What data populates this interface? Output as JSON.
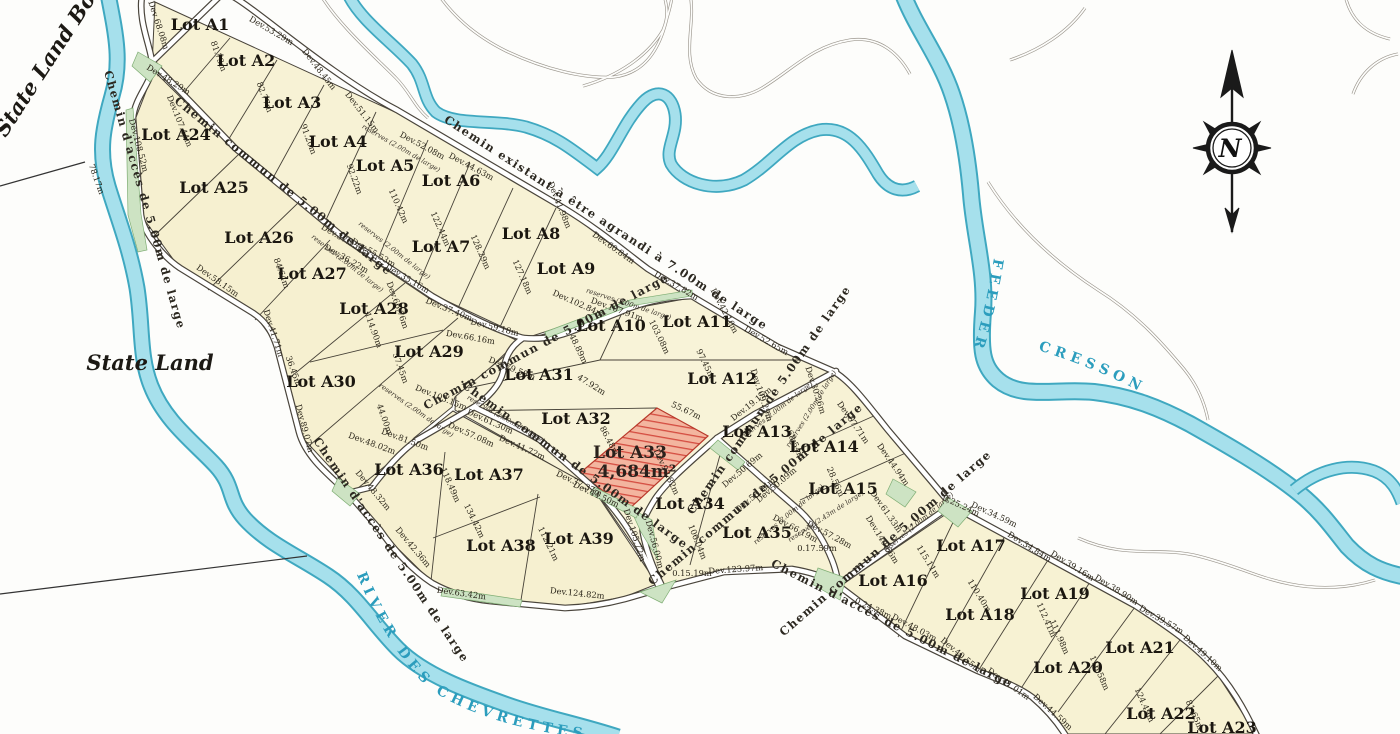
{
  "labels": {
    "state_land": "State Land",
    "state_land_boundary": "State Land Bou",
    "river_left": "RIVER DES CHEVRETTES",
    "feeder": "FEEDER",
    "cresson": "CRESSON",
    "compass_n": "N"
  },
  "highlight": {
    "lot": "Lot A33",
    "area": "4,684m²"
  },
  "colors": {
    "parcel_fill": "#f7f2d5",
    "water_fill": "#a6e0ec",
    "water_edge": "#3fa8c0",
    "highlight_red": "#d84b3c",
    "reserve_green": "#cde3c3",
    "river_text": "#2b9dbd"
  },
  "lots": [
    {
      "id": "A1",
      "label": "Lot A1",
      "x": 200,
      "y": 30
    },
    {
      "id": "A2",
      "label": "Lot A2",
      "x": 246,
      "y": 66
    },
    {
      "id": "A3",
      "label": "Lot A3",
      "x": 292,
      "y": 108
    },
    {
      "id": "A4",
      "label": "Lot A4",
      "x": 338,
      "y": 147
    },
    {
      "id": "A5",
      "label": "Lot A5",
      "x": 385,
      "y": 171
    },
    {
      "id": "A6",
      "label": "Lot A6",
      "x": 451,
      "y": 186
    },
    {
      "id": "A7",
      "label": "Lot A7",
      "x": 441,
      "y": 252
    },
    {
      "id": "A8",
      "label": "Lot A8",
      "x": 531,
      "y": 239
    },
    {
      "id": "A9",
      "label": "Lot A9",
      "x": 566,
      "y": 274
    },
    {
      "id": "A10",
      "label": "Lot A10",
      "x": 611,
      "y": 331
    },
    {
      "id": "A11",
      "label": "Lot A11",
      "x": 697,
      "y": 327
    },
    {
      "id": "A12",
      "label": "Lot A12",
      "x": 722,
      "y": 384
    },
    {
      "id": "A13",
      "label": "Lot A13",
      "x": 757,
      "y": 437
    },
    {
      "id": "A14",
      "label": "Lot A14",
      "x": 824,
      "y": 452
    },
    {
      "id": "A15",
      "label": "Lot A15",
      "x": 843,
      "y": 494
    },
    {
      "id": "A16",
      "label": "Lot A16",
      "x": 893,
      "y": 586
    },
    {
      "id": "A17",
      "label": "Lot A17",
      "x": 971,
      "y": 551
    },
    {
      "id": "A18",
      "label": "Lot A18",
      "x": 980,
      "y": 620
    },
    {
      "id": "A19",
      "label": "Lot A19",
      "x": 1055,
      "y": 599
    },
    {
      "id": "A20",
      "label": "Lot A20",
      "x": 1068,
      "y": 673
    },
    {
      "id": "A21",
      "label": "Lot A21",
      "x": 1140,
      "y": 653
    },
    {
      "id": "A22",
      "label": "Lot A22",
      "x": 1161,
      "y": 719
    },
    {
      "id": "A23",
      "label": "Lot A23",
      "x": 1222,
      "y": 733
    },
    {
      "id": "A24",
      "label": "Lot A24",
      "x": 176,
      "y": 140
    },
    {
      "id": "A25",
      "label": "Lot A25",
      "x": 214,
      "y": 193
    },
    {
      "id": "A26",
      "label": "Lot A26",
      "x": 259,
      "y": 243
    },
    {
      "id": "A27",
      "label": "Lot A27",
      "x": 312,
      "y": 279
    },
    {
      "id": "A28",
      "label": "Lot A28",
      "x": 374,
      "y": 314
    },
    {
      "id": "A29",
      "label": "Lot A29",
      "x": 429,
      "y": 357
    },
    {
      "id": "A30",
      "label": "Lot A30",
      "x": 321,
      "y": 387
    },
    {
      "id": "A31",
      "label": "Lot A31",
      "x": 539,
      "y": 380
    },
    {
      "id": "A32",
      "label": "Lot A32",
      "x": 576,
      "y": 424
    },
    {
      "id": "A34",
      "label": "Lot A34",
      "x": 690,
      "y": 509
    },
    {
      "id": "A35",
      "label": "Lot A35",
      "x": 757,
      "y": 538
    },
    {
      "id": "A36",
      "label": "Lot A36",
      "x": 409,
      "y": 475
    },
    {
      "id": "A37",
      "label": "Lot A37",
      "x": 489,
      "y": 480
    },
    {
      "id": "A38",
      "label": "Lot A38",
      "x": 501,
      "y": 551
    },
    {
      "id": "A39",
      "label": "Lot A39",
      "x": 579,
      "y": 544
    }
  ],
  "road_labels": [
    {
      "t": "Chemin existant à être agrandi à 7.00m de large",
      "x": 604,
      "y": 226,
      "r": 33
    },
    {
      "t": "Chemin d'accès de 5.00m de large",
      "x": 141,
      "y": 201,
      "r": 74
    },
    {
      "t": "Chemin d'accès de 5.00m de large",
      "x": 388,
      "y": 552,
      "r": 56
    },
    {
      "t": "Chemin d'accès de 5.00m de large",
      "x": 890,
      "y": 627,
      "r": 27
    },
    {
      "t": "Chemin commun de 5.00m de large",
      "x": 281,
      "y": 189,
      "r": 39
    },
    {
      "t": "Chemin commun de 5.00m de large",
      "x": 548,
      "y": 345,
      "r": -28
    },
    {
      "t": "Chemin commun de 5.00m de large",
      "x": 573,
      "y": 468,
      "r": 36
    },
    {
      "t": "Chemin commun de 5.00m de large",
      "x": 772,
      "y": 402,
      "r": -55
    },
    {
      "t": "Chemin commun de 5.00m de large",
      "x": 888,
      "y": 546,
      "r": -41
    },
    {
      "t": "Chemin commun de 5.00m de large",
      "x": 758,
      "y": 497,
      "r": -40
    }
  ],
  "dimensions": [
    {
      "t": "Dev 68.08m",
      "x": 156,
      "y": 26,
      "r": 72
    },
    {
      "t": "Dev.53.29m",
      "x": 270,
      "y": 33,
      "r": 30
    },
    {
      "t": "Dev.48.45m",
      "x": 317,
      "y": 71,
      "r": 52
    },
    {
      "t": "Dev.51.15m",
      "x": 360,
      "y": 114,
      "r": 52
    },
    {
      "t": "81.73m",
      "x": 216,
      "y": 57,
      "r": 70
    },
    {
      "t": "82.77m",
      "x": 262,
      "y": 98,
      "r": 70
    },
    {
      "t": "91.20m",
      "x": 306,
      "y": 140,
      "r": 70
    },
    {
      "t": "92.22m",
      "x": 352,
      "y": 180,
      "r": 70
    },
    {
      "t": "Dev.48.29m",
      "x": 167,
      "y": 82,
      "r": 32
    },
    {
      "t": "Dev.107.44m",
      "x": 177,
      "y": 122,
      "r": 68
    },
    {
      "t": "Dev.108.52m",
      "x": 136,
      "y": 146,
      "r": 75
    },
    {
      "t": "78.17m",
      "x": 94,
      "y": 180,
      "r": 70
    },
    {
      "t": "Dev.52.08m",
      "x": 421,
      "y": 148,
      "r": 28
    },
    {
      "t": "Dev.44.63m",
      "x": 470,
      "y": 169,
      "r": 28
    },
    {
      "t": "110.42m",
      "x": 396,
      "y": 207,
      "r": 66
    },
    {
      "t": "122.44m",
      "x": 438,
      "y": 230,
      "r": 66
    },
    {
      "t": "128.29m",
      "x": 478,
      "y": 253,
      "r": 66
    },
    {
      "t": "127.18m",
      "x": 520,
      "y": 278,
      "r": 66
    },
    {
      "t": "Dev.41.98m",
      "x": 557,
      "y": 206,
      "r": 68
    },
    {
      "t": "Dev.60.84m",
      "x": 612,
      "y": 250,
      "r": 35
    },
    {
      "t": "Dev.102.84m",
      "x": 577,
      "y": 306,
      "r": 24
    },
    {
      "t": "Dev.107.91m",
      "x": 616,
      "y": 312,
      "r": 20
    },
    {
      "t": "Dev.37.82m",
      "x": 675,
      "y": 288,
      "r": 30
    },
    {
      "t": "Dev.42.10m",
      "x": 722,
      "y": 312,
      "r": 62
    },
    {
      "t": "Dev.52.65m",
      "x": 765,
      "y": 343,
      "r": 30
    },
    {
      "t": "103.08m",
      "x": 657,
      "y": 338,
      "r": 64
    },
    {
      "t": "97.45m",
      "x": 703,
      "y": 365,
      "r": 64
    },
    {
      "t": "48.89m",
      "x": 576,
      "y": 350,
      "r": 64
    },
    {
      "t": "47.92m",
      "x": 590,
      "y": 387,
      "r": 32
    },
    {
      "t": "55.67m",
      "x": 685,
      "y": 413,
      "r": 25
    },
    {
      "t": "86.48m",
      "x": 607,
      "y": 442,
      "r": 62
    },
    {
      "t": "Dev.79.58m",
      "x": 511,
      "y": 371,
      "r": 22
    },
    {
      "t": "Dev.61.30m",
      "x": 489,
      "y": 424,
      "r": 24
    },
    {
      "t": "Dev.57.08m",
      "x": 470,
      "y": 437,
      "r": 24
    },
    {
      "t": "Dev.41.72m",
      "x": 521,
      "y": 450,
      "r": 24
    },
    {
      "t": "Dev.37.37m",
      "x": 578,
      "y": 486,
      "r": 25
    },
    {
      "t": "Dev.44.50m",
      "x": 595,
      "y": 497,
      "r": 25
    },
    {
      "t": "118.49m",
      "x": 448,
      "y": 486,
      "r": 66
    },
    {
      "t": "134.42m",
      "x": 472,
      "y": 522,
      "r": 64
    },
    {
      "t": "112.21m",
      "x": 546,
      "y": 545,
      "r": 64
    },
    {
      "t": "Dev.48.32m",
      "x": 371,
      "y": 492,
      "r": 50
    },
    {
      "t": "Dev.42.36m",
      "x": 411,
      "y": 549,
      "r": 50
    },
    {
      "t": "Dev.63.42m",
      "x": 461,
      "y": 596,
      "r": 8
    },
    {
      "t": "Dev.124.82m",
      "x": 577,
      "y": 596,
      "r": 6
    },
    {
      "t": "44.00m",
      "x": 382,
      "y": 420,
      "r": 70
    },
    {
      "t": "Dev.48.02m",
      "x": 371,
      "y": 446,
      "r": 20
    },
    {
      "t": "Dev.81.50m",
      "x": 404,
      "y": 442,
      "r": 20
    },
    {
      "t": "Dev.103.15m",
      "x": 440,
      "y": 400,
      "r": 22
    },
    {
      "t": "114.90m",
      "x": 371,
      "y": 331,
      "r": 70
    },
    {
      "t": "57.45m",
      "x": 398,
      "y": 369,
      "r": 70
    },
    {
      "t": "36.45m",
      "x": 291,
      "y": 372,
      "r": 70
    },
    {
      "t": "Dev.58.15m",
      "x": 216,
      "y": 283,
      "r": 35
    },
    {
      "t": "Dev.41.71m",
      "x": 271,
      "y": 334,
      "r": 72
    },
    {
      "t": "Dev.89.07m",
      "x": 302,
      "y": 429,
      "r": 75
    },
    {
      "t": "84.64m",
      "x": 279,
      "y": 274,
      "r": 70
    },
    {
      "t": "Dev.55.53m",
      "x": 372,
      "y": 255,
      "r": 30
    },
    {
      "t": "Dev.35.16m",
      "x": 406,
      "y": 281,
      "r": 30
    },
    {
      "t": "Dev.66.76m",
      "x": 395,
      "y": 306,
      "r": 70
    },
    {
      "t": "Dev.37.40m",
      "x": 448,
      "y": 312,
      "r": 22
    },
    {
      "t": "Dev.59.18m",
      "x": 494,
      "y": 330,
      "r": 14
    },
    {
      "t": "Dev.66.16m",
      "x": 470,
      "y": 340,
      "r": 10
    },
    {
      "t": "Dev.37.95m",
      "x": 342,
      "y": 241,
      "r": 30
    },
    {
      "t": "Dev.36.22m",
      "x": 345,
      "y": 261,
      "r": 30
    },
    {
      "t": "Dev.109.29m",
      "x": 759,
      "y": 396,
      "r": 72
    },
    {
      "t": "Dev.19.15m",
      "x": 753,
      "y": 406,
      "r": -38
    },
    {
      "t": "68.54m",
      "x": 793,
      "y": 446,
      "r": 66
    },
    {
      "t": "28.56m",
      "x": 833,
      "y": 483,
      "r": 66
    },
    {
      "t": "Dev.57.71m",
      "x": 851,
      "y": 424,
      "r": 55
    },
    {
      "t": "Dev.44.94m",
      "x": 891,
      "y": 466,
      "r": 55
    },
    {
      "t": "Dev.61.33m",
      "x": 884,
      "y": 513,
      "r": 55
    },
    {
      "t": "Dev.140.66m",
      "x": 880,
      "y": 541,
      "r": 58
    },
    {
      "t": "0.25.24m",
      "x": 960,
      "y": 508,
      "r": 25
    },
    {
      "t": "Dev.34.59m",
      "x": 993,
      "y": 517,
      "r": 25
    },
    {
      "t": "Dev.34.84m",
      "x": 1028,
      "y": 549,
      "r": 32
    },
    {
      "t": "Dev.39.16m",
      "x": 1071,
      "y": 568,
      "r": 32
    },
    {
      "t": "Dev.38.90m",
      "x": 1115,
      "y": 592,
      "r": 32
    },
    {
      "t": "Dev.39.57m",
      "x": 1160,
      "y": 622,
      "r": 30
    },
    {
      "t": "Dev.49.10m",
      "x": 1201,
      "y": 655,
      "r": 42
    },
    {
      "t": "112.41m",
      "x": 1044,
      "y": 621,
      "r": 66
    },
    {
      "t": "111.98m",
      "x": 1057,
      "y": 638,
      "r": 66
    },
    {
      "t": "116.58m",
      "x": 1097,
      "y": 674,
      "r": 66
    },
    {
      "t": "124.49m",
      "x": 1142,
      "y": 706,
      "r": 66
    },
    {
      "t": "81.65m",
      "x": 1192,
      "y": 716,
      "r": 66
    },
    {
      "t": "115.11m",
      "x": 926,
      "y": 563,
      "r": 58
    },
    {
      "t": "110.40m",
      "x": 977,
      "y": 597,
      "r": 58
    },
    {
      "t": "0.24.38m",
      "x": 872,
      "y": 611,
      "r": 25
    },
    {
      "t": "Dev.48.03m",
      "x": 913,
      "y": 630,
      "r": 28
    },
    {
      "t": "Dev.40.55m",
      "x": 959,
      "y": 657,
      "r": 40
    },
    {
      "t": "Dev.41.01m",
      "x": 1007,
      "y": 686,
      "r": 35
    },
    {
      "t": "Dev.44.59m",
      "x": 1051,
      "y": 714,
      "r": 42
    },
    {
      "t": "0.17.59m",
      "x": 817,
      "y": 551,
      "r": 0
    },
    {
      "t": "0.15.19m",
      "x": 692,
      "y": 576,
      "r": 0
    },
    {
      "t": "Dev.123.97m",
      "x": 736,
      "y": 572,
      "r": -4
    },
    {
      "t": "Dev.105.72m",
      "x": 632,
      "y": 536,
      "r": 72
    },
    {
      "t": "Dev.56.00m",
      "x": 652,
      "y": 545,
      "r": 75
    },
    {
      "t": "106.04m",
      "x": 695,
      "y": 543,
      "r": 68
    },
    {
      "t": "Dev.50.69m",
      "x": 744,
      "y": 472,
      "r": -40
    },
    {
      "t": "Dev.50.09m",
      "x": 778,
      "y": 487,
      "r": -40
    },
    {
      "t": "Dev.58.24m",
      "x": 757,
      "y": 497,
      "r": -40
    },
    {
      "t": "Dev.30.26m",
      "x": 813,
      "y": 391,
      "r": 72
    },
    {
      "t": "Dev.92.82m",
      "x": 664,
      "y": 473,
      "r": 65
    },
    {
      "t": "Dev.66.19m",
      "x": 794,
      "y": 531,
      "r": 28
    },
    {
      "t": "Dev.57.28m",
      "x": 828,
      "y": 537,
      "r": 28
    }
  ],
  "reserves": [
    {
      "t": "reserves (2.00m de large)",
      "x": 400,
      "y": 150,
      "r": 30
    },
    {
      "t": "reserves (2.00m de large)",
      "x": 393,
      "y": 252,
      "r": 38
    },
    {
      "t": "reserves (2.00m de large)",
      "x": 346,
      "y": 265,
      "r": 38
    },
    {
      "t": "reserves (2.00m de large)",
      "x": 628,
      "y": 306,
      "r": 18
    },
    {
      "t": "reserves (2.00m de large)",
      "x": 813,
      "y": 410,
      "r": -58
    },
    {
      "t": "reserves (2.00m de large)",
      "x": 920,
      "y": 524,
      "r": -40
    },
    {
      "t": "reserves (2.00m de large)",
      "x": 505,
      "y": 421,
      "r": 30
    },
    {
      "t": "reserves (2.00m de large)",
      "x": 415,
      "y": 412,
      "r": 35
    },
    {
      "t": "reserves (2.43m de large)",
      "x": 827,
      "y": 518,
      "r": -33
    },
    {
      "t": "reserves (2.00m de large)",
      "x": 778,
      "y": 412,
      "r": -38
    },
    {
      "t": "reserves (2.00m de large)",
      "x": 790,
      "y": 516,
      "r": -40
    }
  ]
}
